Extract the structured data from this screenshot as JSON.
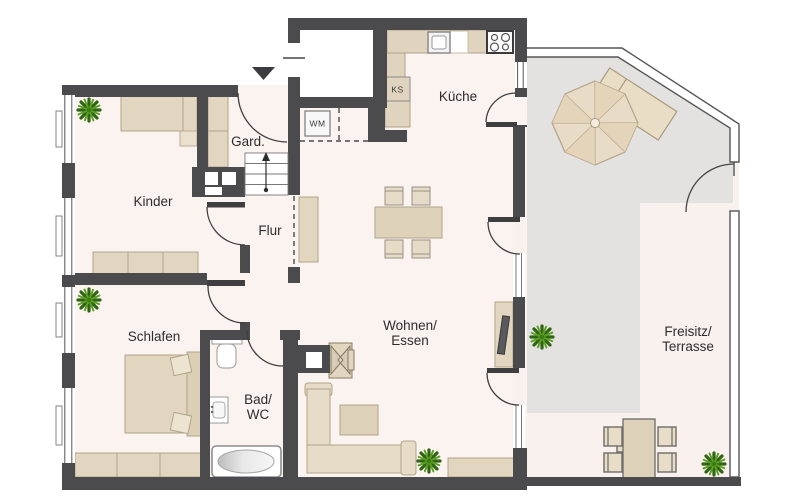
{
  "floorplan": {
    "rooms": {
      "kinder": {
        "label": "Kinder"
      },
      "schlafen": {
        "label": "Schlafen"
      },
      "garderobe": {
        "label": "Gard."
      },
      "flur": {
        "label": "Flur"
      },
      "kueche": {
        "label": "Küche"
      },
      "wohnen_essen": {
        "line1": "Wohnen/",
        "line2": "Essen"
      },
      "bad_wc": {
        "line1": "Bad/",
        "line2": "WC"
      },
      "freisitz_terrasse": {
        "line1": "Freisitz/",
        "line2": "Terrasse"
      }
    },
    "appliances": {
      "washing_machine": {
        "label": "WM"
      },
      "fridge": {
        "label": "KS"
      }
    },
    "colors": {
      "wall": "#4b4a4c",
      "interior_floor": "#fbf3f0",
      "vestibule_floor": "#ffffff",
      "terrace_paving": "#e3e2e0",
      "terrace_floor": "#f8f1ee",
      "furniture_fill": "#e2d6c0",
      "furniture_border": "#b0a489",
      "fixture_white": "#ffffff",
      "plant_green": "#4c8f1f"
    },
    "icons": {
      "entrance_arrow": "▼",
      "stairs_direction_arrow": "↑",
      "plant": "✳",
      "parasol": "◉"
    }
  }
}
